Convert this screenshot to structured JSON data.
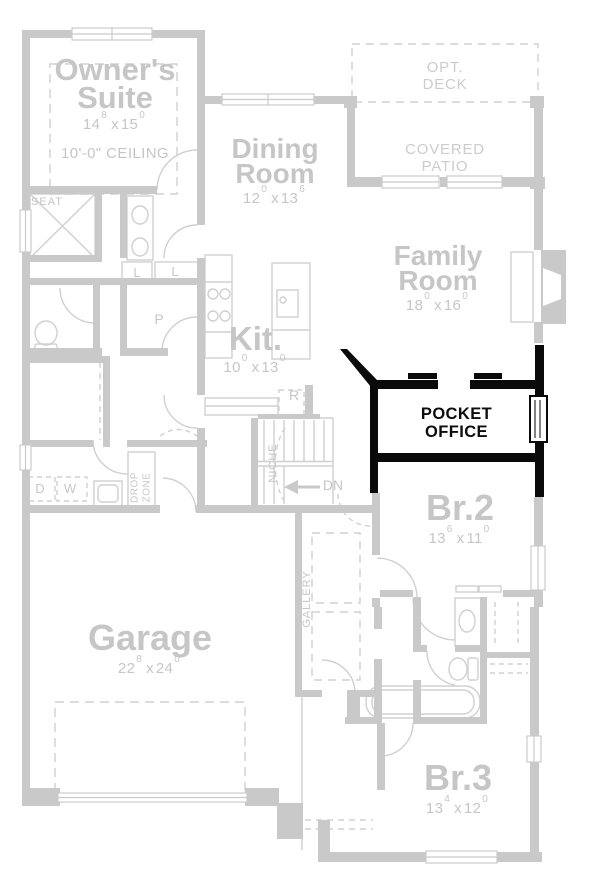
{
  "dim_separator": "x",
  "colors": {
    "wall_gray": "#c9c9c9",
    "line_gray": "#d0d0d0",
    "text_gray": "#c6c6c6",
    "highlight_black": "#0a0a0a",
    "background": "#ffffff"
  },
  "rooms": {
    "owners_suite": {
      "name": "Owner's Suite",
      "w_ft": "14",
      "w_in": "8",
      "l_ft": "15",
      "l_in": "0",
      "ceiling": "10'-0\" CEILING"
    },
    "dining_room": {
      "name": "Dining Room",
      "w_ft": "12",
      "w_in": "0",
      "l_ft": "13",
      "l_in": "6"
    },
    "kitchen": {
      "name": "Kit.",
      "w_ft": "10",
      "w_in": "0",
      "l_ft": "13",
      "l_in": "0"
    },
    "family_room": {
      "name": "Family Room",
      "w_ft": "18",
      "w_in": "0",
      "l_ft": "16",
      "l_in": "0"
    },
    "pocket_office": {
      "name": "POCKET OFFICE"
    },
    "br2": {
      "name": "Br.2",
      "w_ft": "13",
      "w_in": "6",
      "l_ft": "11",
      "l_in": "0"
    },
    "br3": {
      "name": "Br.3",
      "w_ft": "13",
      "w_in": "4",
      "l_ft": "12",
      "l_in": "0"
    },
    "garage": {
      "name": "Garage",
      "w_ft": "22",
      "w_in": "8",
      "l_ft": "24",
      "l_in": "0"
    },
    "opt_deck": {
      "name": "OPT. DECK"
    },
    "covered_patio": {
      "name": "COVERED PATIO"
    }
  },
  "labels": {
    "seat": "SEAT",
    "linen_a": "L",
    "linen_b": "L",
    "pantry": "P",
    "fridge": "R",
    "dryer": "D",
    "washer": "W",
    "down": "DN",
    "niche": "NICHE",
    "drop_zone": "DROP ZONE",
    "gallery": "GALLERY"
  }
}
